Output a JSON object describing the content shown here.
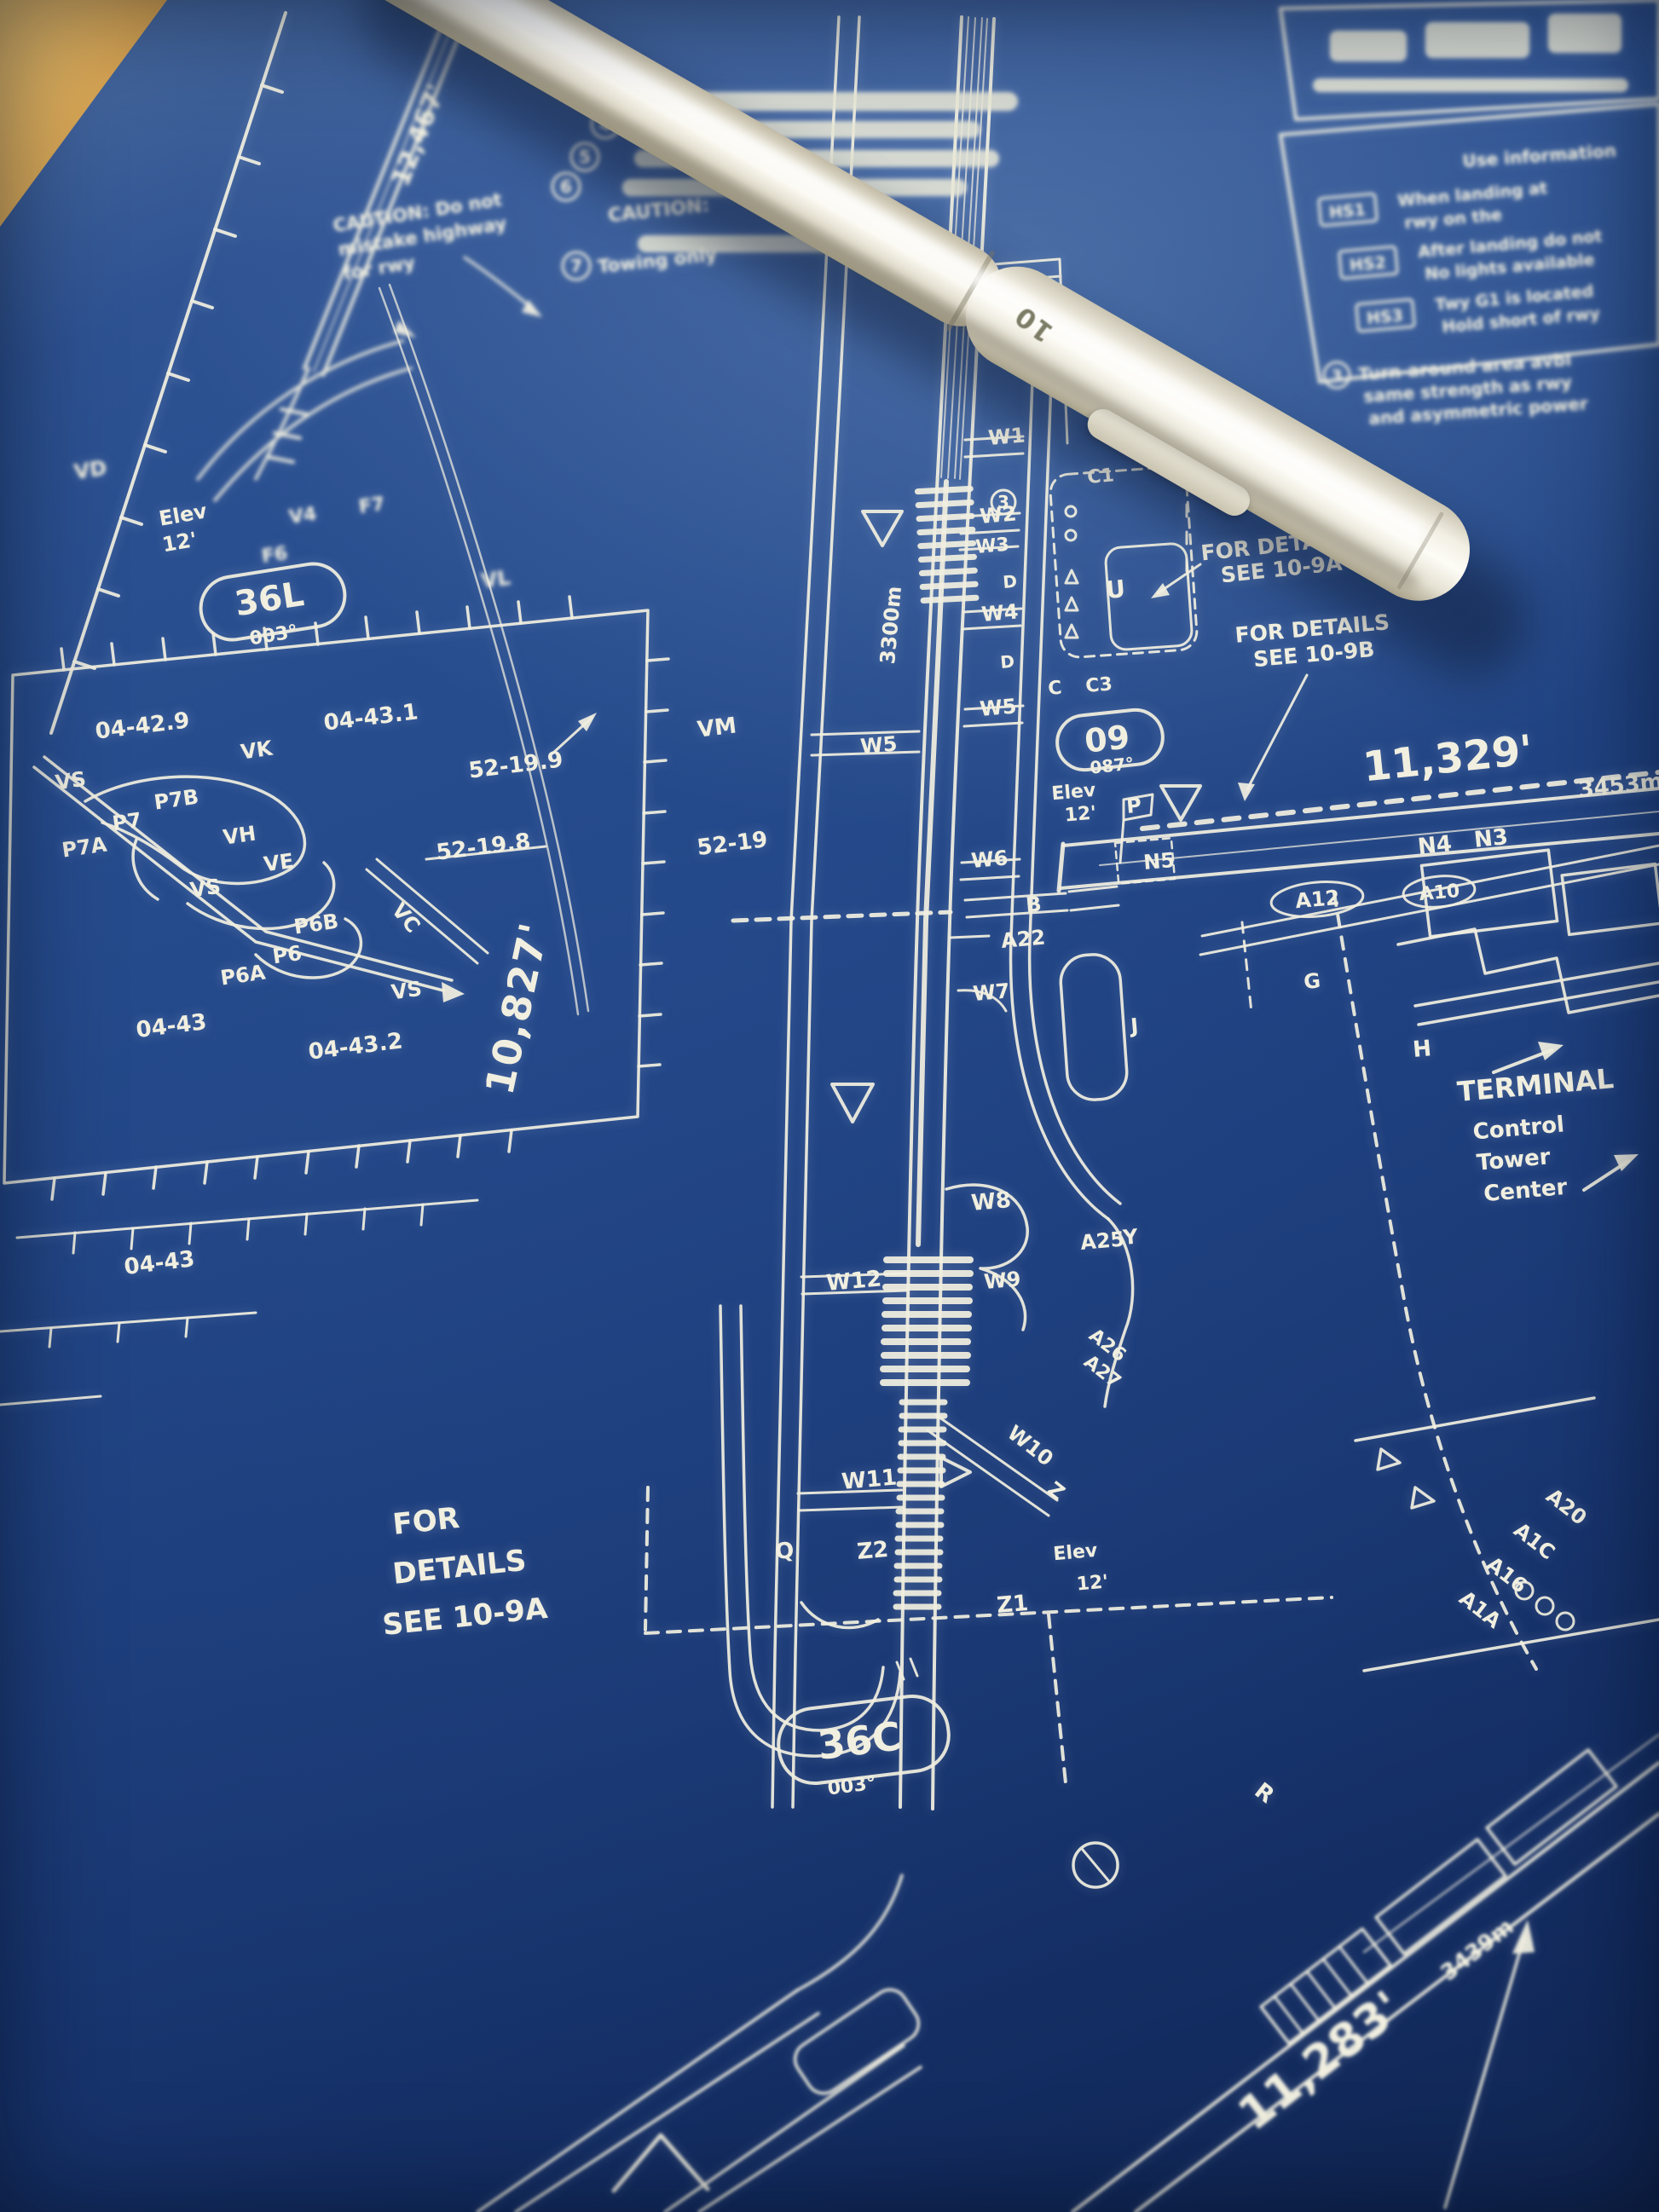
{
  "pen": {
    "marking": "10"
  },
  "colors": {
    "paper_blue": "#1f4180",
    "ink": "#f1efe0",
    "desk_wood": "#d7a452",
    "pen_body": "#efecdf"
  },
  "chart": {
    "runways": [
      {
        "ident": "36L",
        "heading": "003°",
        "length": "12,467'"
      },
      {
        "ident": "36C",
        "heading": "003°",
        "length": "10,827'",
        "length_m": "3300m"
      },
      {
        "ident": "09",
        "heading": "087°",
        "length": "11,329'",
        "length_m": "3453m"
      },
      {
        "length": "11,283'",
        "length_m": "3439m"
      }
    ],
    "elev": {
      "word": "Elev",
      "val": "12'"
    },
    "coords": {
      "c0442_9": "04-42.9",
      "c0443_1": "04-43.1",
      "c5219_9": "52-19.9",
      "c5219_8": "52-19.8",
      "c5219": "52-19",
      "c0443": "04-43",
      "c0443_2": "04-43.2"
    },
    "taxiways": {
      "vm": "VM",
      "vk": "VK",
      "vs": "VS",
      "vh": "VH",
      "ve": "VE",
      "vl": "VL",
      "vc": "VC",
      "vd": "VD",
      "v4": "V4",
      "f7": "F7",
      "f6": "F6",
      "p7": "P7",
      "p7a": "P7A",
      "p7b": "P7B",
      "p6": "P6",
      "p6a": "P6A",
      "p6b": "P6B",
      "w1": "W1",
      "w2": "W2",
      "w3": "W3",
      "w4": "W4",
      "w5": "W5",
      "w6": "W6",
      "w7": "W7",
      "w8": "W8",
      "w9": "W9",
      "w10": "W10",
      "w11": "W11",
      "w12": "W12",
      "z": "Z",
      "z1": "Z1",
      "z2": "Z2",
      "q": "Q",
      "y": "Y",
      "r": "R",
      "u": "U",
      "g": "G",
      "h": "H",
      "j": "J",
      "b": "B",
      "c": "C",
      "d": "D",
      "c1": "C1",
      "c3": "C3",
      "p": "P",
      "n3": "N3",
      "n4": "N4",
      "n5": "N5",
      "a10": "A10",
      "a12": "A12",
      "a22": "A22",
      "a25": "A25",
      "a26": "A26",
      "a27": "A27",
      "a20": "A20",
      "a1c": "A1C",
      "a16": "A16",
      "a1a": "A1A"
    },
    "poi": {
      "terminal": "TERMINAL",
      "control": "Control",
      "tower": "Tower",
      "center": "Center"
    },
    "references": {
      "details_a_l1": "FOR DETAILS",
      "details_a_l2": "SEE 10-9A",
      "details_b_l1": "FOR DETAILS",
      "details_b_l2": "SEE 10-9B",
      "details_c_l1": "FOR",
      "details_c_l2": "DETAILS",
      "details_c_l3": "SEE 10-9A"
    },
    "notes": {
      "note3_num": "3",
      "note3_line1": "Turn-around area avbl",
      "note3_line2": "same strength as rwy",
      "note3_line3": "and asymmetric power",
      "note4_num": "4",
      "note5_num": "5",
      "note6_num": "6",
      "note7_num": "7",
      "caution_word": "CAUTION:",
      "note7_text": "Towing only",
      "caution_line1": "CAUTION: Do not",
      "caution_line2": "mistake highway",
      "caution_line3": "for rwy"
    },
    "hotspots": {
      "header": "Use information",
      "rows": [
        {
          "id": "HS1",
          "line1": "When landing at",
          "line2": "rwy on the"
        },
        {
          "id": "HS2",
          "line1": "After landing do not",
          "line2": "No lights available"
        },
        {
          "id": "HS3",
          "line1": "Twy G1 is located",
          "line2": "Hold short of rwy"
        }
      ]
    }
  }
}
